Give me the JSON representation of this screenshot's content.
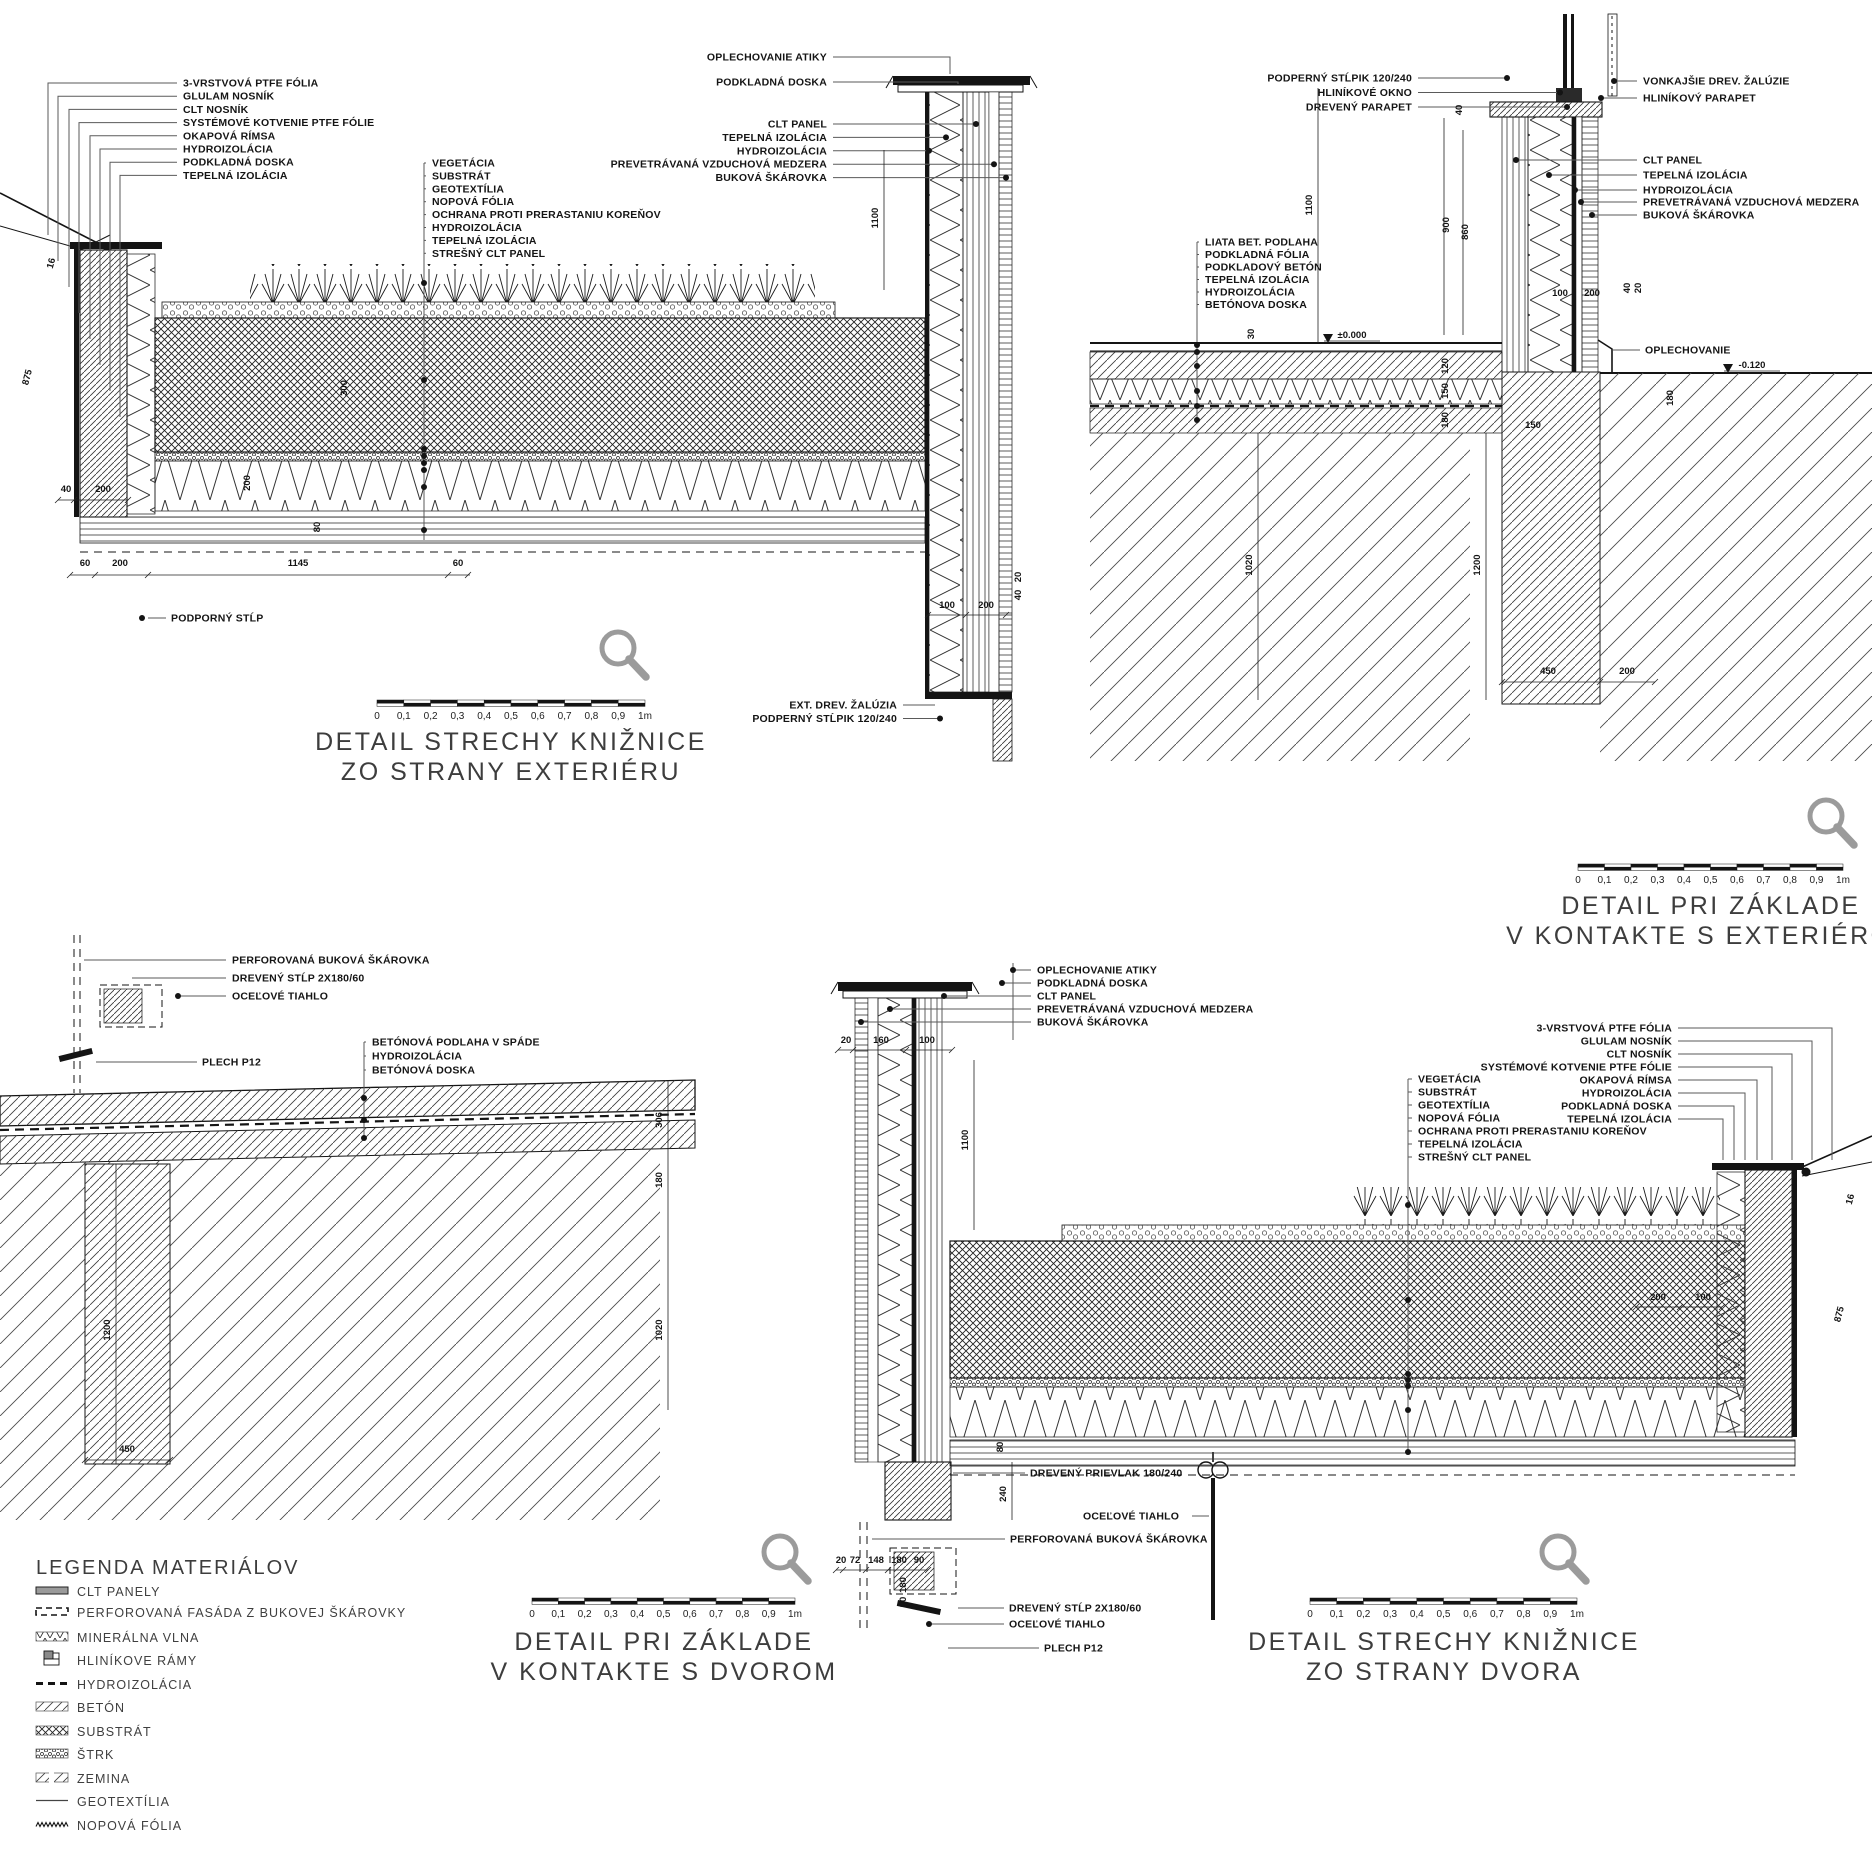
{
  "sheet": {
    "background": "#ffffff",
    "ink": "#141414",
    "leader_gray": "#5a5a5a",
    "magnifier_gray": "#9b9b9b",
    "clt_fill_gray": "#9a9a9a"
  },
  "scale_bar": {
    "ticks": [
      "0",
      "0,1",
      "0,2",
      "0,3",
      "0,4",
      "0,5",
      "0,6",
      "0,7",
      "0,8",
      "0,9",
      "1m"
    ]
  },
  "details": {
    "tl": {
      "title_line1": "DETAIL STRECHY KNIŽNICE",
      "title_line2": "ZO STRANY EXTERIÉRU",
      "left_labels": [
        "3-VRSTVOVÁ PTFE FÓLIA",
        "GLULAM NOSNÍK",
        "CLT NOSNÍK",
        "SYSTÉMOVÉ KOTVENIE PTFE FÓLIE",
        "OKAPOVÁ RÍMSA",
        "HYDROIZOLÁCIA",
        "PODKLADNÁ DOSKA",
        "TEPELNÁ IZOLÁCIA"
      ],
      "middle_labels": [
        "VEGETÁCIA",
        "SUBSTRÁT",
        "GEOTEXTÍLIA",
        "NOPOVÁ FÓLIA",
        "OCHRANA PROTI PRERASTANIU KOREŇOV",
        "HYDROIZOLÁCIA",
        "TEPELNÁ IZOLÁCIA",
        "STREŠNÝ CLT PANEL"
      ],
      "right_labels_top": [
        "OPLECHOVANIE ATIKY",
        "PODKLADNÁ DOSKA"
      ],
      "right_labels": [
        "CLT PANEL",
        "TEPELNÁ IZOLÁCIA",
        "HYDROIZOLÁCIA",
        "PREVETRÁVANÁ VZDUCHOVÁ MEDZERA",
        "BUKOVÁ ŠKÁROVKA"
      ],
      "support_label": "PODPORNÝ STĹP",
      "bottom_right_labels": [
        "EXT. DREV. ŽALÚZIA",
        "PODPERNÝ STĹPIK 120/240"
      ],
      "dims": [
        "875",
        "16",
        "40",
        "200",
        "300",
        "200",
        "80",
        "1100",
        "60",
        "200",
        "1145",
        "60",
        "100",
        "200",
        "40",
        "20"
      ]
    },
    "tr": {
      "title_line1": "DETAIL PRI ZÁKLADE",
      "title_line2": "V KONTAKTE S EXTERIÉROM",
      "left_top_labels": [
        "PODPERNÝ STĹPIK 120/240",
        "HLINÍKOVÉ OKNO",
        "DREVENÝ PARAPET"
      ],
      "floor_labels": [
        "LIATA BET. PODLAHA",
        "PODKLADNÁ FÓLIA",
        "PODKLADOVÝ BETÓN",
        "TEPELNÁ IZOLÁCIA",
        "HYDROIZOLÁCIA",
        "BETÓNOVA DOSKA"
      ],
      "right_labels": [
        "VONKAJŠIE DREV. ŽALÚZIE",
        "HLINÍKOVÝ PARAPET",
        "CLT PANEL",
        "TEPELNÁ IZOLÁCIA",
        "HYDROIZOLÁCIA",
        "PREVETRÁVANÁ VZDUCHOVÁ MEDZERA",
        "BUKOVÁ ŠKÁROVKA"
      ],
      "flashing_label": "OPLECHOVANIE",
      "levels": [
        "±0.000",
        "-0.120"
      ],
      "dims": [
        "40",
        "900",
        "860",
        "1100",
        "30",
        "120",
        "150",
        "180",
        "150",
        "100",
        "200",
        "40",
        "20",
        "1020",
        "1200",
        "450",
        "200",
        "180"
      ]
    },
    "bl": {
      "title_line1": "DETAIL PRI ZÁKLADE",
      "title_line2": "V KONTAKTE S DVOROM",
      "post_labels": [
        "PERFOROVANÁ BUKOVÁ ŠKÁROVKA",
        "DREVENÝ STĹP 2X180/60",
        "OCEĽOVÉ TIAHLO"
      ],
      "plate_label": "PLECH P12",
      "floor_labels": [
        "BETÓNOVÁ PODLAHA V SPÁDE",
        "HYDROIZOLÁCIA",
        "BETÓNOVÁ DOSKA"
      ],
      "dims": [
        "306",
        "180",
        "1020",
        "1200",
        "450"
      ]
    },
    "br": {
      "title_line1": "DETAIL STRECHY KNIŽNICE",
      "title_line2": "ZO STRANY DVORA",
      "top_labels": [
        "OPLECHOVANIE ATIKY",
        "PODKLADNÁ DOSKA",
        "CLT PANEL",
        "PREVETRÁVANÁ VZDUCHOVÁ MEDZERA",
        "BUKOVÁ ŠKÁROVKA"
      ],
      "middle_labels": [
        "VEGETÁCIA",
        "SUBSTRÁT",
        "GEOTEXTÍLIA",
        "NOPOVÁ FÓLIA",
        "OCHRANA PROTI PRERASTANIU KOREŇOV",
        "TEPELNÁ IZOLÁCIA",
        "STREŠNÝ CLT PANEL"
      ],
      "right_labels": [
        "3-VRSTVOVÁ PTFE FÓLIA",
        "GLULAM NOSNÍK",
        "CLT NOSNÍK",
        "SYSTÉMOVÉ KOTVENIE PTFE FÓLIE",
        "OKAPOVÁ RÍMSA",
        "HYDROIZOLÁCIA",
        "PODKLADNÁ DOSKA",
        "TEPELNÁ IZOLÁCIA"
      ],
      "bottom_labels": [
        "DREVENÝ PRIEVLAK 180/240",
        "OCEĽOVÉ TIAHLO",
        "PERFOROVANÁ BUKOVÁ ŠKÁROVKA",
        "DREVENÝ STĹP 2X180/60",
        "OCEĽOVÉ TIAHLO",
        "PLECH P12"
      ],
      "dims": [
        "20",
        "160",
        "100",
        "1100",
        "80",
        "240",
        "20",
        "72",
        "148",
        "180",
        "90",
        "180",
        "90",
        "200",
        "100",
        "875",
        "16"
      ]
    }
  },
  "legend": {
    "title": "LEGENDA MATERIÁLOV",
    "items": [
      {
        "label": "CLT PANELY",
        "swatch": "clt"
      },
      {
        "label": "PERFOROVANÁ FASÁDA Z BUKOVEJ ŠKÁROVKY",
        "swatch": "perforated"
      },
      {
        "label": "MINERÁLNA VLNA",
        "swatch": "mineral-wool"
      },
      {
        "label": "HLINÍKOVE RÁMY",
        "swatch": "alu-frames"
      },
      {
        "label": "HYDROIZOLÁCIA",
        "swatch": "hydro"
      },
      {
        "label": "BETÓN",
        "swatch": "beton"
      },
      {
        "label": "SUBSTRÁT",
        "swatch": "substrat"
      },
      {
        "label": "ŠTRK",
        "swatch": "strk"
      },
      {
        "label": "ZEMINA",
        "swatch": "zemina"
      },
      {
        "label": "GEOTEXTÍLIA",
        "swatch": "geotextilia"
      },
      {
        "label": "NOPOVÁ FÓLIA",
        "swatch": "nopova"
      }
    ]
  }
}
